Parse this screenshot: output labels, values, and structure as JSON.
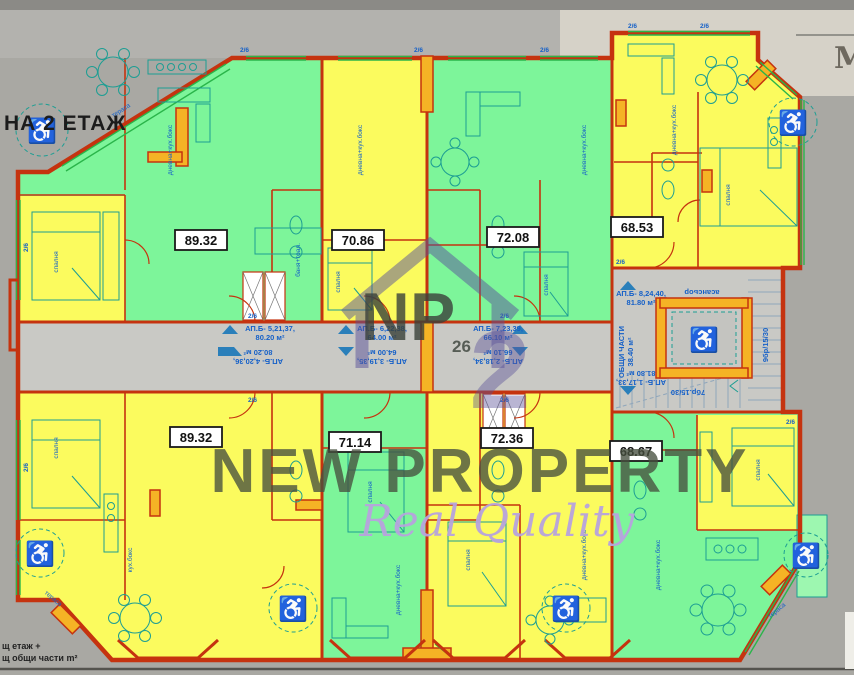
{
  "scene": {
    "floor_label": "НА 2 ЕТАЖ",
    "corner_letter": "M",
    "legend_line1": "щ етаж +",
    "legend_line2": "щ общи части m²"
  },
  "watermark": {
    "initials": "NP",
    "number": "26",
    "brand": "NEW PROPERTY",
    "tagline": "Real Quality"
  },
  "apartments": [
    {
      "position": "top-left",
      "area": "89.32",
      "color": "green"
    },
    {
      "position": "top-mid-left",
      "area": "70.86",
      "color": "yellow"
    },
    {
      "position": "top-mid-right",
      "area": "72.08",
      "color": "green"
    },
    {
      "position": "top-right",
      "area": "68.53",
      "color": "yellow"
    },
    {
      "position": "bottom-left",
      "area": "89.32",
      "color": "yellow"
    },
    {
      "position": "bottom-mid-left",
      "area": "71.14",
      "color": "green"
    },
    {
      "position": "bottom-mid-right",
      "area": "72.36",
      "color": "yellow"
    },
    {
      "position": "bottom-right",
      "area": "68.67",
      "color": "green"
    }
  ],
  "corridor": {
    "labels": [
      {
        "apt": "АП.Б- 5,21,37,",
        "size": "80.20 м²",
        "orientation": "up"
      },
      {
        "apt": "АП.Б- 6,22,38,",
        "size": "64.00 м²",
        "orientation": "up"
      },
      {
        "apt": "АП.Б- 7,23,39,",
        "size": "66.10 м²",
        "orientation": "up"
      },
      {
        "apt": "АП.Б- 8,24,40,",
        "size": "81.80 м²",
        "orientation": "up"
      },
      {
        "apt": "АП.Б- 4,20,36,",
        "size": "80.20 м²",
        "orientation": "down"
      },
      {
        "apt": "АП.Б- 3,19,35,",
        "size": "64.00 м²",
        "orientation": "down"
      },
      {
        "apt": "АП.Б- 2,18,34,",
        "size": "66.10 м²",
        "orientation": "down"
      },
      {
        "apt": "АП.Б- 1,17,33,",
        "size": "81.80 м²",
        "orientation": "down"
      }
    ],
    "common_area": "ОБЩИ ЧАСТИ",
    "common_area_size": "38.40 м²",
    "elevator": "асансьор",
    "stairs_right_flight": "9бр/15/30",
    "stairs_left_flight": "7бр.15/30"
  },
  "rooms": [
    {
      "t": "дневна+кух.бокс"
    },
    {
      "t": "спалня"
    },
    {
      "t": "тераса"
    },
    {
      "t": "баня+тоал."
    },
    {
      "t": "дневна+кух.бокс"
    },
    {
      "t": "спалня"
    },
    {
      "t": "дневна+кух.бокс"
    },
    {
      "t": "спалня"
    },
    {
      "t": "дневна+кух.бокс"
    },
    {
      "t": "спалня"
    },
    {
      "t": "спалня"
    },
    {
      "t": "кух.бокс"
    },
    {
      "t": "спалня"
    },
    {
      "t": "дневна+кух.бокс"
    },
    {
      "t": "спалня"
    },
    {
      "t": "дневна+кух.бокс"
    },
    {
      "t": "спалня"
    },
    {
      "t": "дневна+кух.бокс"
    },
    {
      "t": "тераса"
    },
    {
      "t": "тераса"
    }
  ],
  "plan": {
    "window_tag": "2/6"
  },
  "colors": {
    "apartment_green": "#7df59a",
    "apartment_yellow": "#fbfb5e",
    "wall_red": "#c5330f",
    "wall_fill_orange": "#f5b325",
    "corridor_gray": "#c9c9c5",
    "outside_gray": "#a9a8a3",
    "outside_light": "#d6d2c8",
    "annotation_blue": "#1560c8",
    "window_green": "#2ab54a",
    "furniture_teal": "#1d9e93",
    "watermark_purple": "#5a5199"
  }
}
